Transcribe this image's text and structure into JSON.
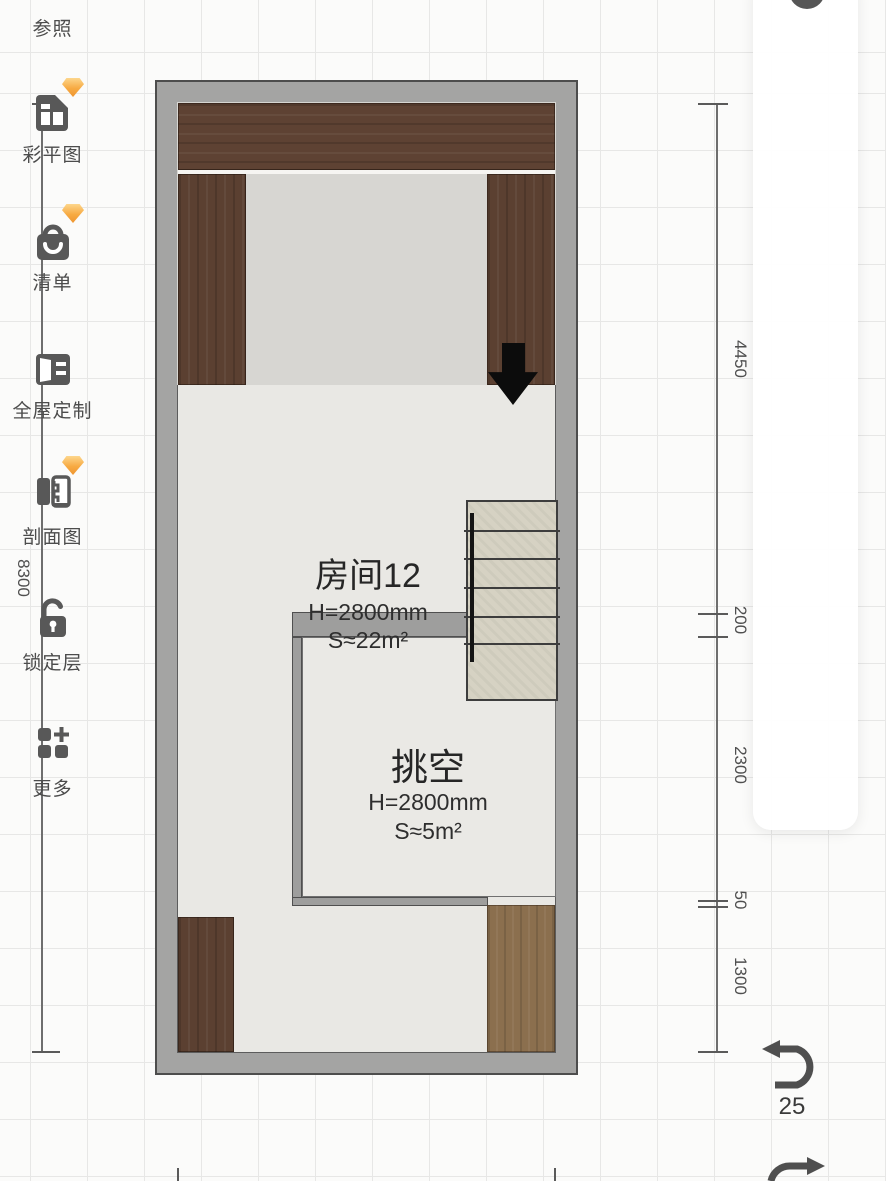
{
  "rooms": {
    "room12": {
      "name": "房间12",
      "height": "H=2800mm",
      "area": "S≈22m²"
    },
    "void": {
      "name": "挑空",
      "height": "H=2800mm",
      "area": "S≈5m²"
    }
  },
  "dimensions": {
    "left": {
      "total": "8300"
    },
    "right": {
      "seg0": "4450",
      "seg1": "200",
      "seg2": "2300",
      "seg3": "50",
      "seg4": "1300"
    }
  },
  "toolbar": {
    "items": [
      {
        "label": "参照",
        "premium": false
      },
      {
        "label": "彩平图",
        "premium": true
      },
      {
        "label": "清单",
        "premium": true
      },
      {
        "label": "全屋定制",
        "premium": false
      },
      {
        "label": "剖面图",
        "premium": true
      },
      {
        "label": "锁定层",
        "premium": false
      },
      {
        "label": "更多",
        "premium": false
      }
    ]
  },
  "history": {
    "undo_count": "25"
  },
  "colors": {
    "wall": "#a4a4a3",
    "floor": "#e9e8e4",
    "wood_dark": "#5e4233",
    "wood_tan": "#8b6f4e",
    "stairs": "#d6d2c3",
    "premium_gem": "#f7aa42"
  }
}
